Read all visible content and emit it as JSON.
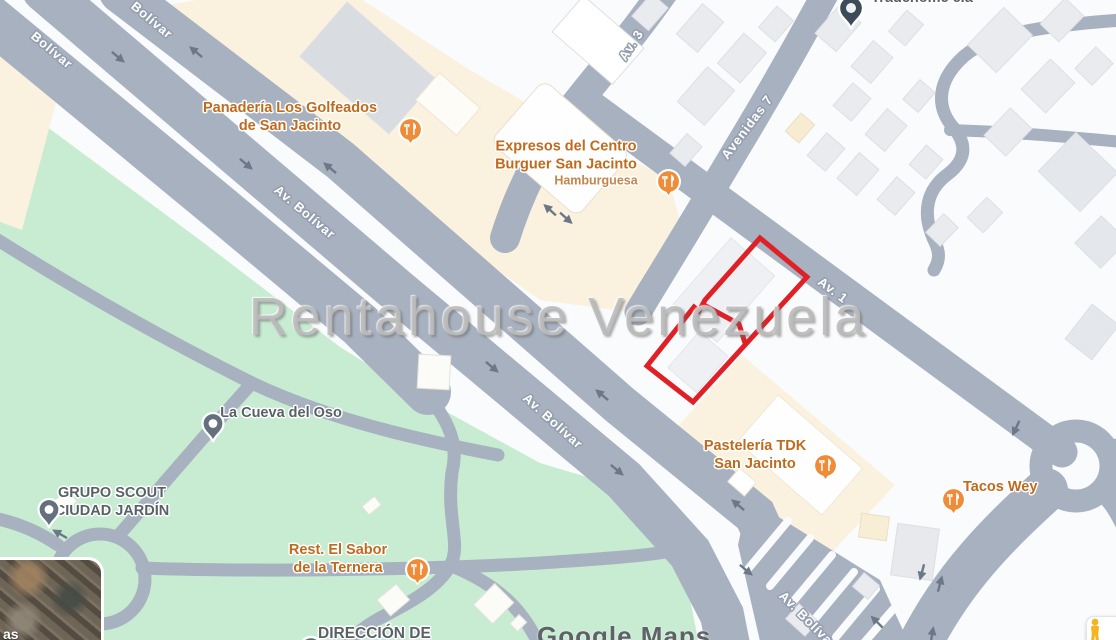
{
  "watermark": {
    "text": "Rentahouse Venezuela"
  },
  "attribution": {
    "brand": "Google",
    "product": "Maps"
  },
  "inset": {
    "partial_text": "as"
  },
  "road_labels": [
    {
      "text": "Bolívar"
    },
    {
      "text": "Bolívar"
    },
    {
      "text": "Av. Bolívar"
    },
    {
      "text": "Av. Bolívar"
    },
    {
      "text": "Av. Bolívar"
    },
    {
      "text": "Av. 3"
    },
    {
      "text": "Avenidas 7"
    },
    {
      "text": "Av. 1"
    }
  ],
  "pois": [
    {
      "id": "panaderia",
      "line1": "Panadería Los Golfeados",
      "line2": "de San Jacinto",
      "type": "restaurant"
    },
    {
      "id": "expresos",
      "line1": "Expresos del Centro",
      "line2": "Burguer San Jacinto",
      "subtitle": "Hamburguesa",
      "type": "restaurant"
    },
    {
      "id": "pasteleria",
      "line1": "Pastelería TDK",
      "line2": "San Jacinto",
      "type": "restaurant"
    },
    {
      "id": "tacos-wey",
      "line1": "Tacos Wey",
      "type": "restaurant"
    },
    {
      "id": "rest-el-sabor",
      "line1": "Rest. El Sabor",
      "line2": "de la Ternera",
      "type": "restaurant"
    },
    {
      "id": "la-cueva-del-oso",
      "line1": "La Cueva del Oso",
      "type": "place"
    },
    {
      "id": "grupo-scout",
      "line1": "GRUPO SCOUT",
      "line2": "CIUDAD JARDÍN",
      "type": "place"
    },
    {
      "id": "direccion",
      "line1": "DIRECCIÓN DE",
      "type": "place"
    },
    {
      "id": "tradehome",
      "line1": "Tradehome c.a",
      "type": "place"
    }
  ],
  "colors": {
    "selection_outline_red": "#df2127",
    "poi_icon_orange": "#ef8c38",
    "poi_text_orange": "#bf6b1d",
    "road_fill": "#a8b1c0",
    "park_green": "#c7ecd2",
    "commercial_cream": "#faf2df"
  }
}
